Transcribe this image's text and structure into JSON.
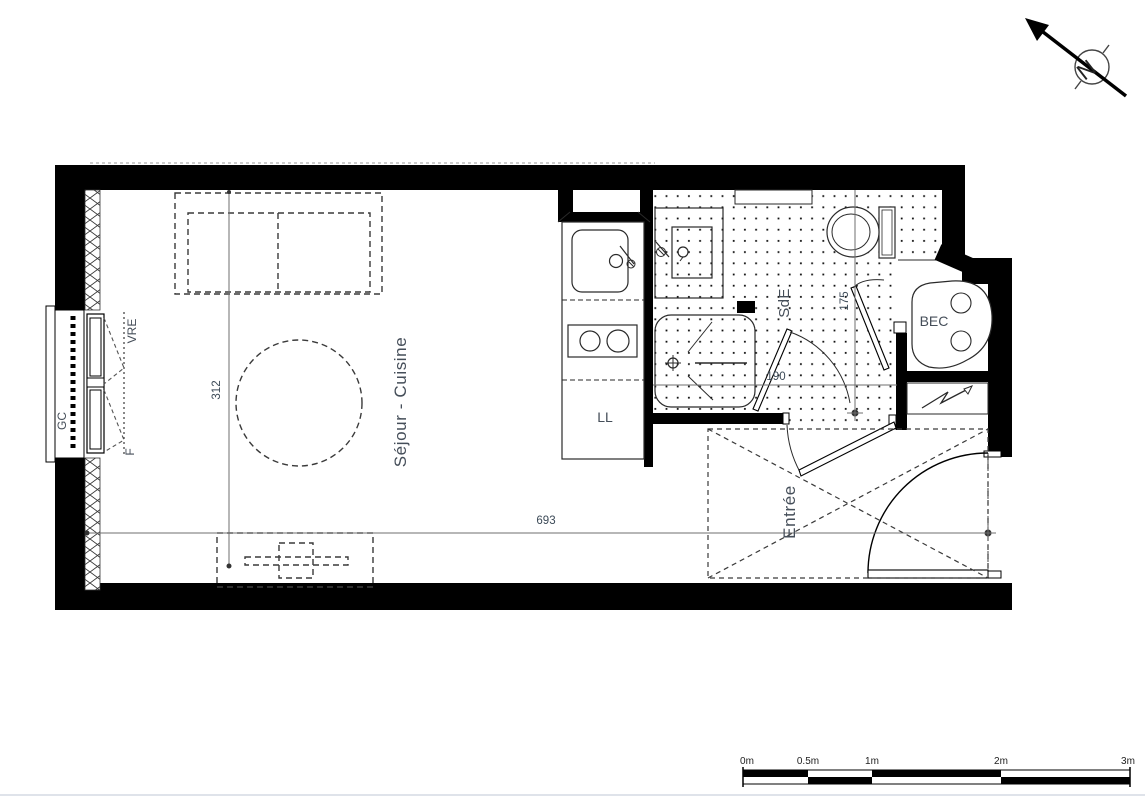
{
  "plan": {
    "type": "studio-apartment-floor-plan",
    "rooms": {
      "living": "Séjour - Cuisine",
      "entry": "Entrée",
      "shower_room": "SdE"
    },
    "labels": {
      "washing_machine": "LL",
      "water_heater": "BEC",
      "guardrail": "GC",
      "roller_shutter": "VRE",
      "window": "F",
      "north": "N"
    },
    "dimensions": {
      "living_depth_cm": "312",
      "total_length_cm": "693",
      "sde_depth_cm": "175",
      "sde_width_cm": "190"
    },
    "scale_bar": {
      "ticks": [
        "0m",
        "0.5m",
        "1m",
        "2m",
        "3m"
      ]
    },
    "colors": {
      "wall": "#000000",
      "room_text": "#454e59",
      "dim_text": "#3c4a57",
      "line": "#2a2a2a",
      "centerline": "#6f6f6f"
    }
  }
}
